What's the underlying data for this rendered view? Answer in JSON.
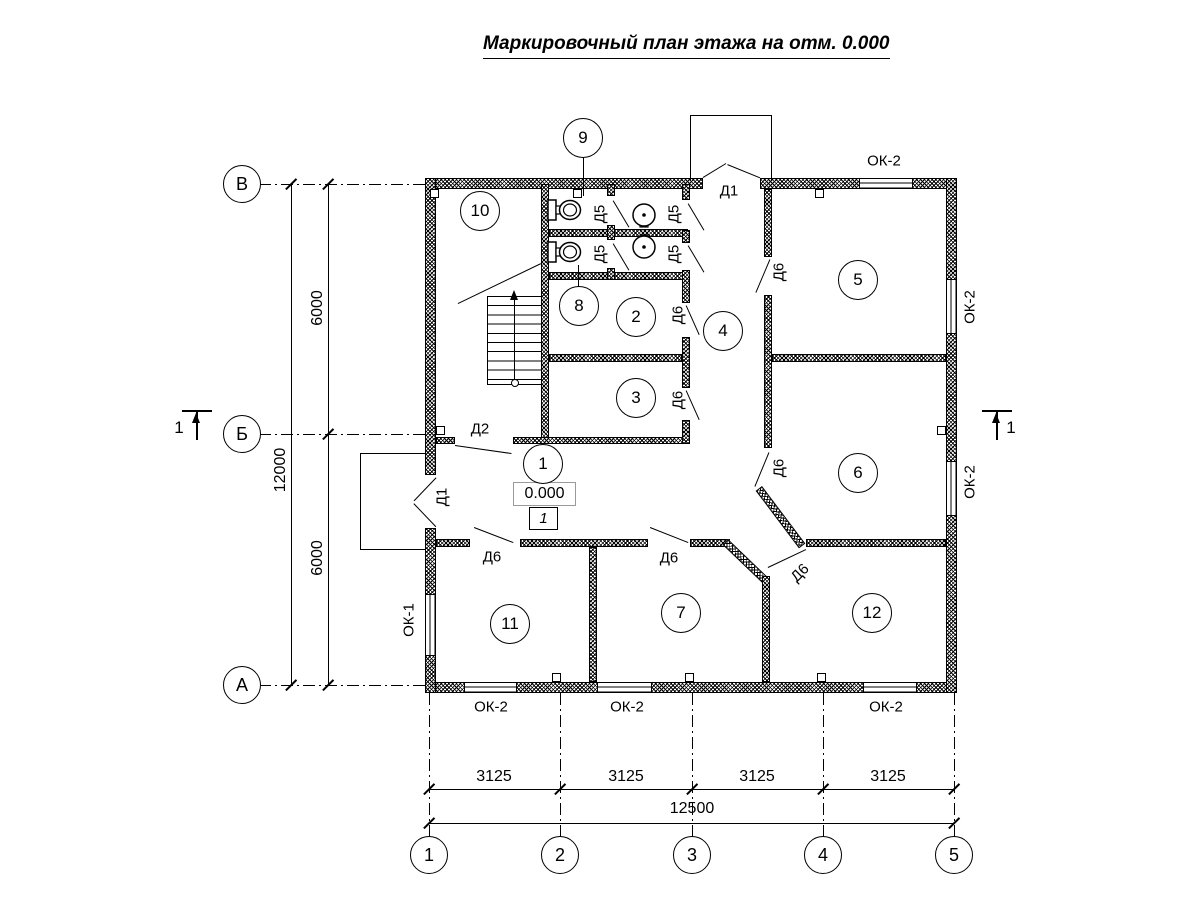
{
  "title": "Маркировочный план этажа на отм. 0.000",
  "plan": {
    "elevation_mark": "0.000",
    "floor_number": "1"
  },
  "rooms": [
    {
      "number": "1",
      "x": 543,
      "y": 464
    },
    {
      "number": "2",
      "x": 636,
      "y": 317
    },
    {
      "number": "3",
      "x": 636,
      "y": 398
    },
    {
      "number": "4",
      "x": 723,
      "y": 331
    },
    {
      "number": "5",
      "x": 858,
      "y": 280
    },
    {
      "number": "6",
      "x": 858,
      "y": 473
    },
    {
      "number": "7",
      "x": 681,
      "y": 613
    },
    {
      "number": "8",
      "x": 579,
      "y": 306
    },
    {
      "number": "9",
      "x": 583,
      "y": 138
    },
    {
      "number": "10",
      "x": 480,
      "y": 211
    },
    {
      "number": "11",
      "x": 510,
      "y": 624
    },
    {
      "number": "12",
      "x": 872,
      "y": 613
    }
  ],
  "door_marks": [
    {
      "text": "Д1",
      "x": 442,
      "y": 497,
      "rot": -90
    },
    {
      "text": "Д1",
      "x": 729,
      "y": 191,
      "rot": 0
    },
    {
      "text": "Д2",
      "x": 480,
      "y": 429,
      "rot": 0
    },
    {
      "text": "Д5",
      "x": 600,
      "y": 214,
      "rot": -90
    },
    {
      "text": "Д5",
      "x": 600,
      "y": 254,
      "rot": -90
    },
    {
      "text": "Д5",
      "x": 674,
      "y": 214,
      "rot": -90
    },
    {
      "text": "Д5",
      "x": 674,
      "y": 254,
      "rot": -90
    },
    {
      "text": "Д6",
      "x": 678,
      "y": 315,
      "rot": -90
    },
    {
      "text": "Д6",
      "x": 678,
      "y": 400,
      "rot": -90
    },
    {
      "text": "Д6",
      "x": 779,
      "y": 272,
      "rot": -90
    },
    {
      "text": "Д6",
      "x": 779,
      "y": 468,
      "rot": -90
    },
    {
      "text": "Д6",
      "x": 492,
      "y": 557,
      "rot": 0
    },
    {
      "text": "Д6",
      "x": 669,
      "y": 558,
      "rot": 0
    },
    {
      "text": "Д6",
      "x": 800,
      "y": 573,
      "rot": -45
    }
  ],
  "window_marks": [
    {
      "text": "ОК-1",
      "x": 409,
      "y": 620,
      "rot": -90
    },
    {
      "text": "ОК-2",
      "x": 884,
      "y": 161,
      "rot": 0
    },
    {
      "text": "ОК-2",
      "x": 970,
      "y": 307,
      "rot": -90
    },
    {
      "text": "ОК-2",
      "x": 970,
      "y": 482,
      "rot": -90
    },
    {
      "text": "ОК-2",
      "x": 491,
      "y": 707,
      "rot": 0
    },
    {
      "text": "ОК-2",
      "x": 627,
      "y": 707,
      "rot": 0
    },
    {
      "text": "ОК-2",
      "x": 886,
      "y": 707,
      "rot": 0
    }
  ],
  "axes": {
    "vertical": [
      {
        "label": "В",
        "x": 242,
        "y": 184
      },
      {
        "label": "Б",
        "x": 242,
        "y": 434
      },
      {
        "label": "А",
        "x": 242,
        "y": 685
      }
    ],
    "horizontal": [
      {
        "label": "1",
        "x": 429,
        "y": 855
      },
      {
        "label": "2",
        "x": 560,
        "y": 855
      },
      {
        "label": "3",
        "x": 692,
        "y": 855
      },
      {
        "label": "4",
        "x": 823,
        "y": 855
      },
      {
        "label": "5",
        "x": 954,
        "y": 855
      }
    ]
  },
  "dimensions": {
    "vertical": [
      {
        "text": "6000",
        "x": 318,
        "y": 308,
        "rot": -90
      },
      {
        "text": "6000",
        "x": 318,
        "y": 558,
        "rot": -90
      },
      {
        "text": "12000",
        "x": 281,
        "y": 470,
        "rot": -90
      }
    ],
    "horizontal": [
      {
        "text": "3125",
        "x": 494,
        "y": 777,
        "rot": 0
      },
      {
        "text": "3125",
        "x": 626,
        "y": 777,
        "rot": 0
      },
      {
        "text": "3125",
        "x": 757,
        "y": 777,
        "rot": 0
      },
      {
        "text": "3125",
        "x": 888,
        "y": 777,
        "rot": 0
      },
      {
        "text": "12500",
        "x": 692,
        "y": 809,
        "rot": 0
      }
    ]
  },
  "section_marks": [
    {
      "text": "1",
      "x": 179,
      "y": 428
    },
    {
      "text": "1",
      "x": 1011,
      "y": 428
    }
  ]
}
